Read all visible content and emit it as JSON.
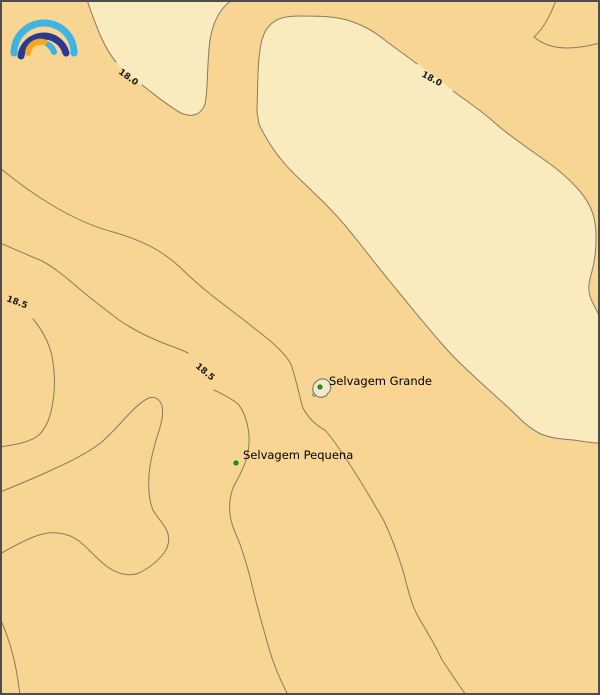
{
  "map": {
    "type": "isoline-contour-map",
    "region_name": "Selvagens Islands area",
    "islands": [
      {
        "name": "Selvagem Grande",
        "marker": "green-dot"
      },
      {
        "name": "Selvagem Pequena",
        "marker": "green-dot"
      }
    ],
    "contour_labels": [
      {
        "value": "18.0",
        "position": "upper-left"
      },
      {
        "value": "18.0",
        "position": "upper-center-right"
      },
      {
        "value": "18.5",
        "position": "left-edge"
      },
      {
        "value": "18.5",
        "position": "center"
      }
    ],
    "contour_levels": [
      "18.0",
      "18.5"
    ]
  },
  "colors": {
    "sea_warm_tan": "#F8D592",
    "sea_cool_cream": "#FAEBBE",
    "contour_line": "#8A7A60",
    "contour_label_text": "#1A1A1A",
    "place_label_text": "#000000",
    "island_fill": "#EFE9CE",
    "island_outline": "#6E6E5E",
    "marker_green": "#1DA51D",
    "marker_green_edge": "#0A5F0A",
    "frame_border": "#4D4D4D",
    "logo_cyan": "#3EB4E4",
    "logo_navy": "#2B3990",
    "logo_orange": "#F7A823"
  },
  "logo": {
    "name": "rainbow-arcs-logo"
  }
}
